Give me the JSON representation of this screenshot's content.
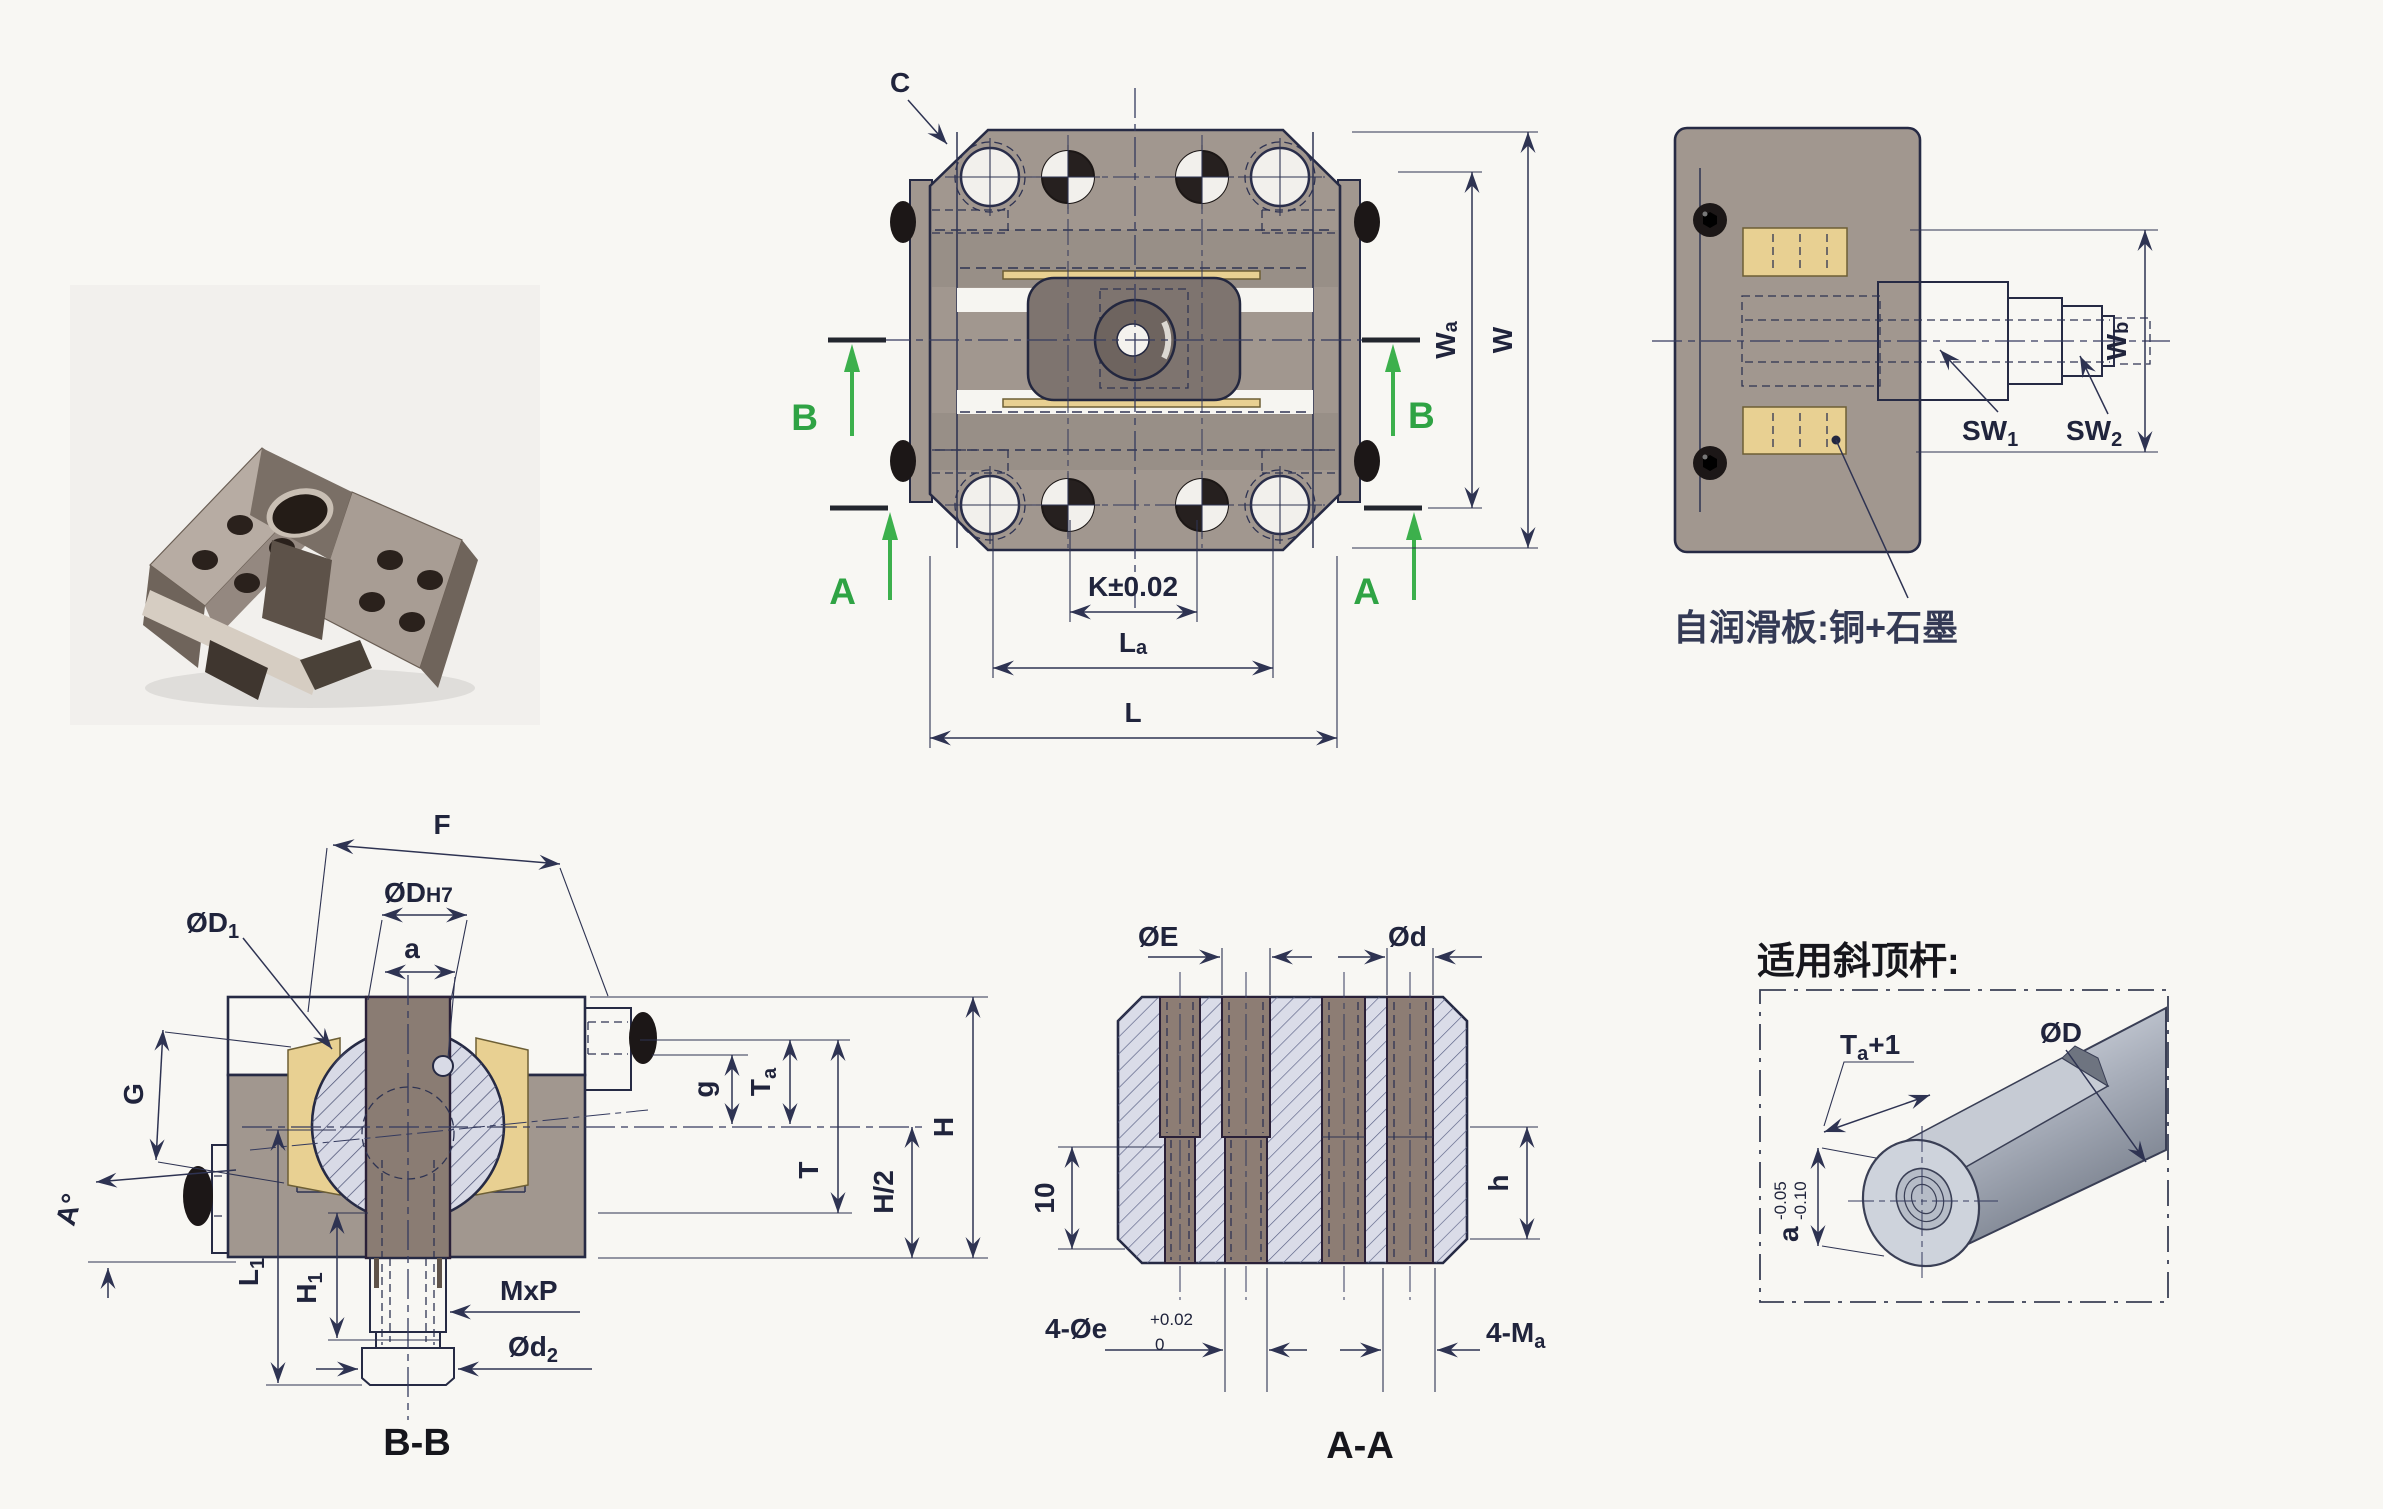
{
  "drawing": {
    "type": "engineering-drawing",
    "subject": "slide-core / angle-ejector guide unit",
    "colors": {
      "accent_green": "#3cb04c",
      "brass_plate": "#e8d092",
      "steel_gray": "#a1978f",
      "section_hatch_fill": "#d8dae6",
      "line_navy": "#2e3352"
    }
  },
  "top_view": {
    "detail_c": "C",
    "section_b": "B",
    "section_a": "A",
    "dim_k": "K±0.02",
    "dim_la_main": "L",
    "dim_la_sub": "a",
    "dim_l": "L",
    "dim_wa_main": "W",
    "dim_wa_sub": "a",
    "dim_w": "W"
  },
  "side_view": {
    "dim_wb_main": "W",
    "dim_wb_sub": "b",
    "sw1_main": "SW",
    "sw1_sub": "1",
    "sw2_main": "SW",
    "sw2_sub": "2",
    "note": "自润滑板:铜+石墨"
  },
  "section_bb": {
    "title": "B-B",
    "dim_f": "F",
    "dim_dh7_main": "ØD",
    "dim_dh7_fit": "H7",
    "dim_d1_main": "ØD",
    "dim_d1_sub": "1",
    "dim_a": "a",
    "dim_g_upper": "G",
    "dim_angle": "A°",
    "dim_l1_main": "L",
    "dim_l1_sub": "1",
    "dim_h1_main": "H",
    "dim_h1_sub": "1",
    "dim_mxp": "MxP",
    "dim_d2_main": "Ød",
    "dim_d2_sub": "2",
    "dim_g_lower": "g",
    "dim_ta_main": "T",
    "dim_ta_sub": "a",
    "dim_t": "T",
    "dim_h_half": "H/2",
    "dim_h": "H"
  },
  "section_aa": {
    "title": "A-A",
    "dim_e": "ØE",
    "dim_d": "Ød",
    "dim_10": "10",
    "dim_h": "h",
    "dim_4e_main": "4-Øe",
    "dim_4e_tol_up": "+0.02",
    "dim_4e_tol_dn": "0",
    "dim_4ma_main": "4-M",
    "dim_4ma_sub": "a"
  },
  "rod_view": {
    "title": "适用斜顶杆:",
    "dim_ta1_main": "T",
    "dim_ta1_sub": "a",
    "dim_ta1_rest": "+1",
    "dim_d": "ØD",
    "dim_a_main": "a",
    "dim_a_tol_up": "-0.05",
    "dim_a_tol_dn": "-0.10"
  }
}
